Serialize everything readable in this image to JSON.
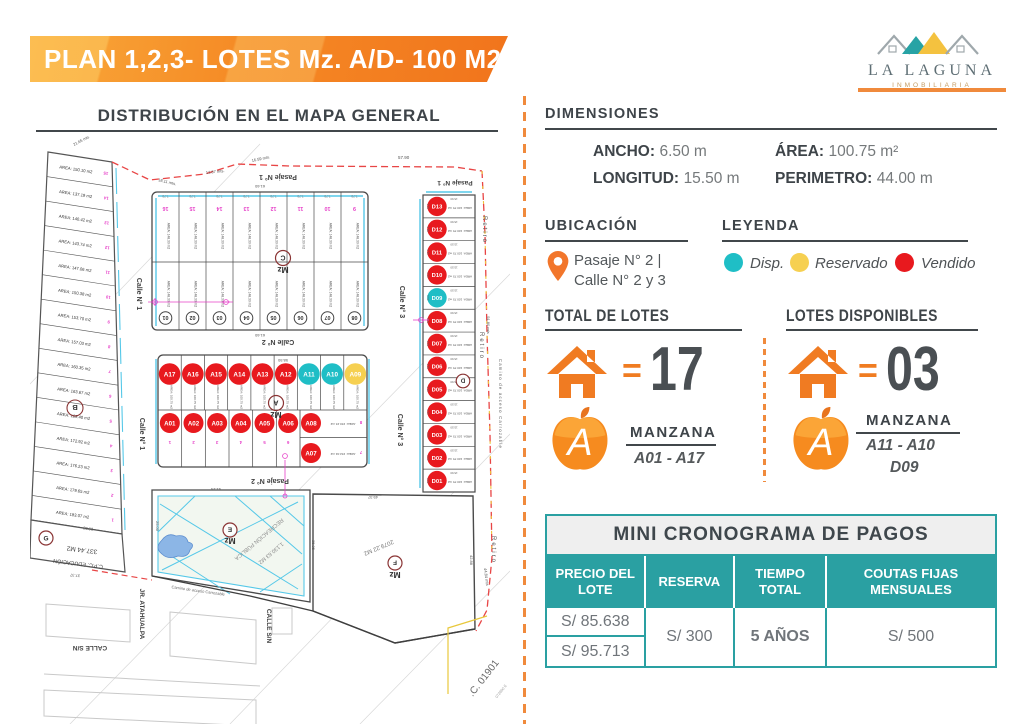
{
  "header": {
    "title": "PLAN 1,2,3- LOTES Mz. A/D- 100 M2",
    "logo_name": "LA LAGUNA",
    "logo_subtitle": "INMOBILIARIA"
  },
  "map": {
    "title": "DISTRIBUCIÓN EN EL MAPA GENERAL",
    "streets": {
      "pasaje1": "Pasaje N° 1",
      "pasaje2": "Pasaje N° 2",
      "calle1": "Calle N° 1",
      "calle2": "Calle N° 2",
      "calle3": "Calle N° 3",
      "retiro": "Retiro",
      "jr_atahualpa": "JR. ATAHUALPA",
      "calle_sn": "CALLE S/N",
      "camino": "Camino de acceso Carrozable",
      "cc": ".C. 01901"
    },
    "colors": {
      "d": "#1FBEC6",
      "r": "#F6D051",
      "v": "#E8191E"
    },
    "mzB": {
      "label": "B",
      "lots": [
        {
          "n": "15",
          "area": "AREA: 150.10 m2"
        },
        {
          "n": "14",
          "area": "AREA: 137.19 m2"
        },
        {
          "n": "13",
          "area": "AREA: 140.42 m2"
        },
        {
          "n": "12",
          "area": "AREA: 143.74 m2"
        },
        {
          "n": "11",
          "area": "AREA: 147.06 m2"
        },
        {
          "n": "10",
          "area": "AREA: 150.38 m2"
        },
        {
          "n": "9",
          "area": "AREA: 153.70 m2"
        },
        {
          "n": "8",
          "area": "AREA: 157.03 m2"
        },
        {
          "n": "7",
          "area": "AREA: 160.35 m2"
        },
        {
          "n": "6",
          "area": "AREA: 163.67 m2"
        },
        {
          "n": "5",
          "area": "AREA: 169.40 m2"
        },
        {
          "n": "4",
          "area": "AREA: 172.92 m2"
        },
        {
          "n": "3",
          "area": "AREA: 176.23 m2"
        },
        {
          "n": "2",
          "area": "AREA: 179.65 m2"
        },
        {
          "n": "1",
          "area": "AREA: 183.07 m2"
        }
      ],
      "g_label": "G",
      "g_area": "337.44 M2",
      "g_name": "C.P.C. EDUCACIÓN"
    },
    "mzC": {
      "label_mz": "Mz",
      "label": "C",
      "top_nums": [
        "16",
        "15",
        "14",
        "13",
        "12",
        "11",
        "10",
        "9"
      ],
      "bottom_nums": [
        "01",
        "02",
        "03",
        "04",
        "05",
        "06",
        "07",
        "08"
      ],
      "lot_area": "AREA: 148.30 m2",
      "lot_w": "7.70"
    },
    "mzA": {
      "label_mz": "Mz",
      "label": "A",
      "top": [
        {
          "id": "A17",
          "s": "v"
        },
        {
          "id": "A16",
          "s": "v"
        },
        {
          "id": "A15",
          "s": "v"
        },
        {
          "id": "A14",
          "s": "v"
        },
        {
          "id": "A13",
          "s": "v"
        },
        {
          "id": "A12",
          "s": "v"
        },
        {
          "id": "A11",
          "s": "d"
        },
        {
          "id": "A10",
          "s": "d"
        },
        {
          "id": "A09",
          "s": "r"
        }
      ],
      "bottom": [
        {
          "id": "A01",
          "s": "v"
        },
        {
          "id": "A02",
          "s": "v"
        },
        {
          "id": "A03",
          "s": "v"
        },
        {
          "id": "A04",
          "s": "v"
        },
        {
          "id": "A05",
          "s": "v"
        },
        {
          "id": "A06",
          "s": "v"
        }
      ],
      "bottom_nums": [
        "1",
        "2",
        "3",
        "4",
        "5",
        "6"
      ],
      "right": [
        {
          "id": "A08",
          "s": "v",
          "area": "AREA: 150.15 m2",
          "num": "8"
        },
        {
          "id": "A07",
          "s": "v",
          "area": "AREA: 152.04 m2",
          "num": "7"
        }
      ],
      "lot_area": "AREA: 100.75 m2"
    },
    "mzD": {
      "label": "D",
      "lots": [
        {
          "id": "D13",
          "s": "v"
        },
        {
          "id": "D12",
          "s": "v"
        },
        {
          "id": "D11",
          "s": "v"
        },
        {
          "id": "D10",
          "s": "v"
        },
        {
          "id": "D09",
          "s": "d"
        },
        {
          "id": "D08",
          "s": "v"
        },
        {
          "id": "D07",
          "s": "v"
        },
        {
          "id": "D06",
          "s": "v"
        },
        {
          "id": "D05",
          "s": "v"
        },
        {
          "id": "D04",
          "s": "v"
        },
        {
          "id": "D03",
          "s": "v"
        },
        {
          "id": "D02",
          "s": "v"
        },
        {
          "id": "D01",
          "s": "v"
        }
      ],
      "lot_area": "AREA: 100.75 m2",
      "lot_w": "15.50",
      "lot_h": "6.50"
    },
    "mzE": {
      "label_mz": "Mz",
      "label": "E",
      "name": "RECREACIÓN PÚBLICA",
      "area": "1,130.63 M2"
    },
    "mzF": {
      "label_mz": "Mz",
      "label": "F",
      "area": "2079.22 M2"
    },
    "measurements": [
      "57.90",
      "18.11 mts.",
      "13.87 mts.",
      "16.59 mts.",
      "21.65 mts",
      "91.80 mts",
      "44.84 mts",
      "49.37",
      "42.88",
      "41.24",
      "35.35",
      "61.60",
      "58.50",
      "25.00",
      "28.03",
      "37.37",
      "072900 E"
    ]
  },
  "panel": {
    "dimensiones": {
      "heading": "DIMENSIONES",
      "ancho_label": "ANCHO:",
      "ancho": "6.50 m",
      "area_label": "ÁREA:",
      "area": "100.75 m²",
      "longitud_label": "LONGITUD:",
      "longitud": "15.50 m",
      "perimetro_label": "PERIMETRO:",
      "perimetro": "44.00 m"
    },
    "ubicacion": {
      "heading": "UBICACIÓN",
      "line1": "Pasaje N° 2 |",
      "line2": "Calle N° 2 y 3"
    },
    "leyenda": {
      "heading": "LEYENDA",
      "items": [
        {
          "label": "Disp.",
          "color": "#1FBEC6"
        },
        {
          "label": "Reservado",
          "color": "#F6D051"
        },
        {
          "label": "Vendido",
          "color": "#E8191E"
        }
      ]
    },
    "total": {
      "heading": "TOTAL DE LOTES",
      "equals": "=",
      "value": "17",
      "manzana_label": "MANZANA",
      "range": "A01 - A17"
    },
    "disponibles": {
      "heading": "LOTES DISPONIBLES",
      "equals": "=",
      "value": "03",
      "manzana_label": "MANZANA",
      "range": "A11 - A10",
      "range2": "D09"
    },
    "tabla": {
      "title": "MINI CRONOGRAMA DE PAGOS",
      "headers": [
        "PRECIO DEL LOTE",
        "RESERVA",
        "TIEMPO TOTAL",
        "COUTAS FIJAS MENSUALES"
      ],
      "precio1": "S/ 85.638",
      "precio2": "S/ 95.713",
      "reserva": "S/ 300",
      "tiempo": "5 AÑOS",
      "cuota": "S/ 500"
    }
  }
}
